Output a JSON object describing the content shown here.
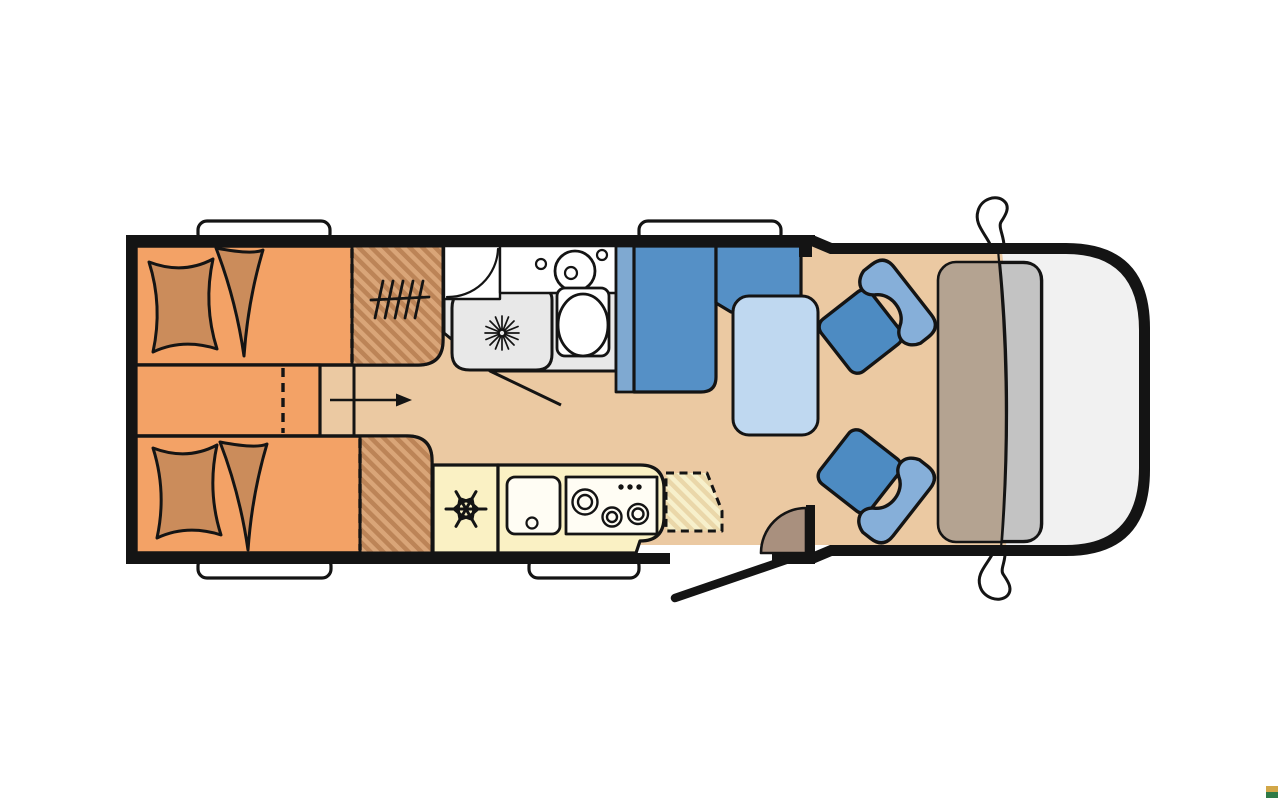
{
  "page": {
    "background": "#FFFFFF"
  },
  "floorplan": {
    "type": "motorhome-top-view",
    "areas": [
      "rear-twin-beds",
      "wardrobes",
      "washroom",
      "kitchen",
      "dinette",
      "cab"
    ]
  },
  "icons": {
    "snowflake_icon": "fridge-freezer symbol (6-arm snowflake)",
    "shower_drain_icon": "12-ray star drain symbol",
    "heater_icon": "hatch-lines heater symbol",
    "walkway_arrow_icon": "right-pointing arrow",
    "burner_icons": "3 concentric-circle hob burners",
    "mirror_icon": "side mirror squiggle",
    "door_swing_icon": "entry door swing line and quarter arc"
  },
  "colors": {
    "wall": "#141414",
    "bed_orange": "#F3A266",
    "bedding_brown": "#CB8C5B",
    "wardrobe_hatch_base": "#BC8457",
    "wardrobe_hatch_stripe": "#D9A578",
    "floor_tan": "#EBC9A2",
    "bath_gray": "#E8E8E8",
    "fixture_white": "#FFFFFF",
    "kitchen_cream": "#FAF1C4",
    "appliance_white": "#FFFDF4",
    "opt_hatch_base": "#EAD7A9",
    "opt_hatch_stripe": "#F7F0CB",
    "bench_blue": "#5590C6",
    "bench_back_strip": "#7FA9D1",
    "table_blue": "#BFD8F0",
    "seat_cushion_blue": "#4D8BC2",
    "seat_back_blue": "#86AFD9",
    "dashboard_taupe": "#B4A391",
    "dashboard_front_gray": "#C3C3C3",
    "windshield_gray": "#F1F1F1",
    "door_arc_brown": "#A9907E",
    "window_white": "#FFFFFF",
    "marker_gold": "#D2A748",
    "marker_green": "#2F7A46"
  }
}
